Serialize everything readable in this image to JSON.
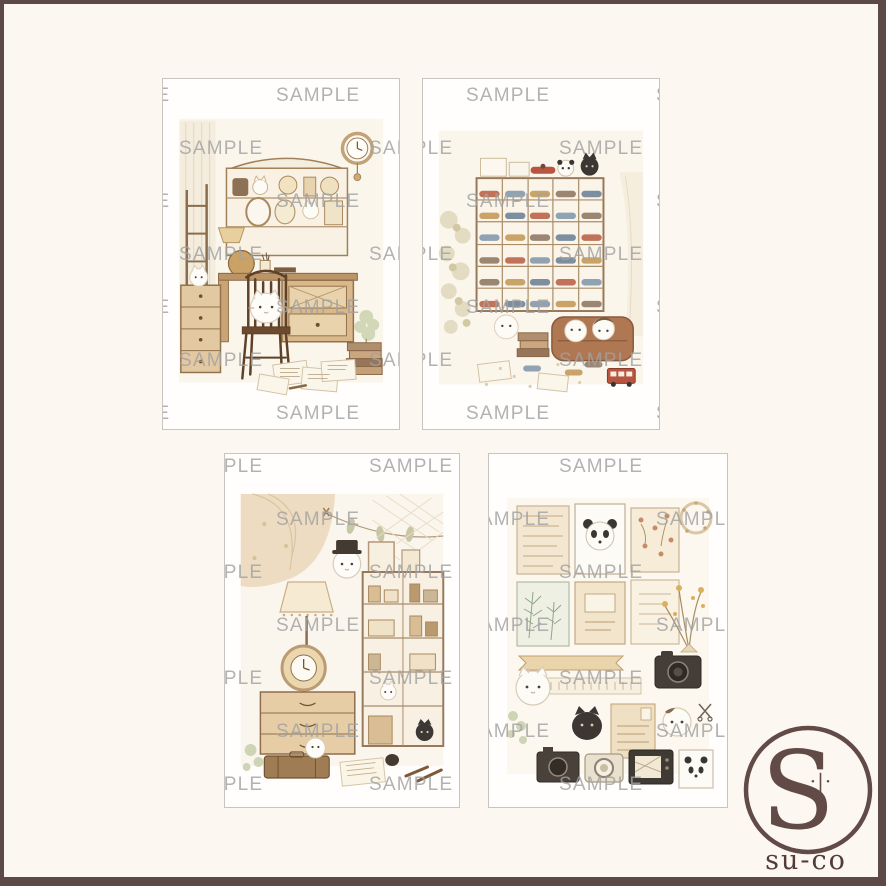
{
  "page": {
    "background_color": "#fdf7f2",
    "frame_color": "#5d4a47",
    "card_background": "#fffefc",
    "card_border_color": "#c8c5c1"
  },
  "watermark": {
    "text": "SAMPLE",
    "color": "#a2a2a2",
    "opacity": 0.82,
    "font_size": 19,
    "letter_spacing": 1.2,
    "grid": {
      "dx": 190,
      "dy": 53,
      "y0": 95,
      "x0_even": 85,
      "x0_odd": 178,
      "rows": 14,
      "cols": 4
    }
  },
  "cards": [
    {
      "id": "card-1",
      "description": "watercolor illustration: white hamster cats at an antique vanity desk with hutch shelves, ladder shelf, wall clock and wooden chair"
    },
    {
      "id": "card-2",
      "description": "watercolor illustration: shelf of collectible toy cars with a black cat on top and hamsters on a brown sofa"
    },
    {
      "id": "card-3",
      "description": "watercolor illustration: antique shop corner with curtain, lamp, ornate clock, chest of drawers and display shelf"
    },
    {
      "id": "card-4",
      "description": "watercolor illustration: collage of vintage postcards, cameras, dried flowers, pandas, white and black cats"
    }
  ],
  "logo": {
    "monogram": "S",
    "marks": "·|·",
    "name": "su-co",
    "color": "#5a423d"
  }
}
